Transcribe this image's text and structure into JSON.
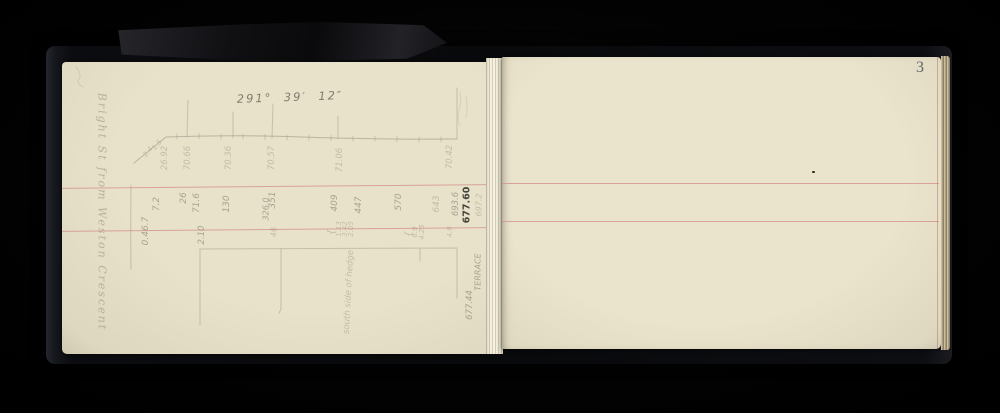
{
  "page_number": "3",
  "heading_bearing": "291°  39′  12″",
  "left_caption": "Bright St from Weston Crescent",
  "colors": {
    "page_cream": "#e8e2ca",
    "rule_red": "#d4928f",
    "pencil_gray": "#8f897b",
    "dark_ink": "#3e3b35",
    "cover_black": "#0b0c0f"
  },
  "annotations": [
    {
      "text": "2.4",
      "x": 86,
      "y": 90,
      "rot": -50,
      "size": 7,
      "tone": "faint"
    },
    {
      "text": "1.5",
      "x": 95,
      "y": 83,
      "rot": -50,
      "size": 7,
      "tone": "faint"
    },
    {
      "text": "26.92",
      "x": 103,
      "y": 96,
      "rot": -90,
      "size": 8.5,
      "tone": "faint"
    },
    {
      "text": "70.66",
      "x": 126,
      "y": 96,
      "rot": -90,
      "size": 8.5,
      "tone": "faint"
    },
    {
      "text": "70.36",
      "x": 167,
      "y": 96,
      "rot": -90,
      "size": 8.5,
      "tone": "faint"
    },
    {
      "text": "70.57",
      "x": 210,
      "y": 96,
      "rot": -90,
      "size": 8.5,
      "tone": "faint"
    },
    {
      "text": "71.06",
      "x": 278,
      "y": 98,
      "rot": -90,
      "size": 8.5,
      "tone": "faint"
    },
    {
      "text": "70.42",
      "x": 388,
      "y": 95,
      "rot": -90,
      "size": 8.5,
      "tone": "faint"
    },
    {
      "text": "0.46.7",
      "x": 84,
      "y": 169,
      "rot": -90,
      "size": 9,
      "tone": "normal"
    },
    {
      "text": "7.2",
      "x": 95,
      "y": 142,
      "rot": -90,
      "size": 9,
      "tone": "normal"
    },
    {
      "text": "26",
      "x": 122,
      "y": 136,
      "rot": -90,
      "size": 9,
      "tone": "normal"
    },
    {
      "text": "71.6",
      "x": 135,
      "y": 141,
      "rot": -90,
      "size": 9,
      "tone": "normal"
    },
    {
      "text": "130",
      "x": 165,
      "y": 142,
      "rot": -90,
      "size": 9,
      "tone": "normal"
    },
    {
      "text": "351",
      "x": 211,
      "y": 138,
      "rot": -90,
      "size": 9,
      "tone": "normal"
    },
    {
      "text": "326.0",
      "x": 204,
      "y": 147,
      "rot": -90,
      "size": 8,
      "tone": "normal"
    },
    {
      "text": "409",
      "x": 273,
      "y": 141,
      "rot": -90,
      "size": 9,
      "tone": "normal"
    },
    {
      "text": "447",
      "x": 297,
      "y": 143,
      "rot": -90,
      "size": 9,
      "tone": "normal"
    },
    {
      "text": "570",
      "x": 337,
      "y": 140,
      "rot": -90,
      "size": 9,
      "tone": "normal"
    },
    {
      "text": "643",
      "x": 375,
      "y": 142,
      "rot": -90,
      "size": 9,
      "tone": "faint"
    },
    {
      "text": "693.6",
      "x": 394,
      "y": 142,
      "rot": -90,
      "size": 8.5,
      "tone": "normal"
    },
    {
      "text": "677.60",
      "x": 405,
      "y": 143,
      "rot": -90,
      "size": 9.5,
      "tone": "dark"
    },
    {
      "text": "697.2",
      "x": 417,
      "y": 143,
      "rot": -90,
      "size": 8,
      "tone": "faint"
    },
    {
      "text": "4.9",
      "x": 388,
      "y": 170,
      "rot": -90,
      "size": 7,
      "tone": "faint"
    },
    {
      "text": "2.10",
      "x": 140,
      "y": 173,
      "rot": -90,
      "size": 8.5,
      "tone": "normal"
    },
    {
      "text": "46",
      "x": 212,
      "y": 170,
      "rot": -90,
      "size": 8,
      "tone": "faint"
    },
    {
      "text": "{",
      "x": 270,
      "y": 170,
      "rot": -90,
      "size": 10,
      "tone": "faint"
    },
    {
      "text": "1.13",
      "x": 277,
      "y": 167,
      "rot": -90,
      "size": 7,
      "tone": "faint"
    },
    {
      "text": "3.42",
      "x": 283,
      "y": 167,
      "rot": -90,
      "size": 7,
      "tone": "faint"
    },
    {
      "text": "2.05",
      "x": 289,
      "y": 167,
      "rot": -90,
      "size": 7,
      "tone": "faint"
    },
    {
      "text": "{",
      "x": 347,
      "y": 172,
      "rot": -90,
      "size": 10,
      "tone": "faint"
    },
    {
      "text": "6.9",
      "x": 353,
      "y": 170,
      "rot": -90,
      "size": 7,
      "tone": "faint"
    },
    {
      "text": "4.25",
      "x": 360,
      "y": 170,
      "rot": -90,
      "size": 7,
      "tone": "faint"
    },
    {
      "text": "south side of hedge",
      "x": 287,
      "y": 230,
      "rot": -87,
      "size": 8.5,
      "tone": "faint"
    },
    {
      "text": "TERRACE",
      "x": 416,
      "y": 210,
      "rot": -90,
      "size": 8,
      "tone": "normal"
    },
    {
      "text": "677.44",
      "x": 408,
      "y": 243,
      "rot": -90,
      "size": 8.5,
      "tone": "normal"
    }
  ]
}
